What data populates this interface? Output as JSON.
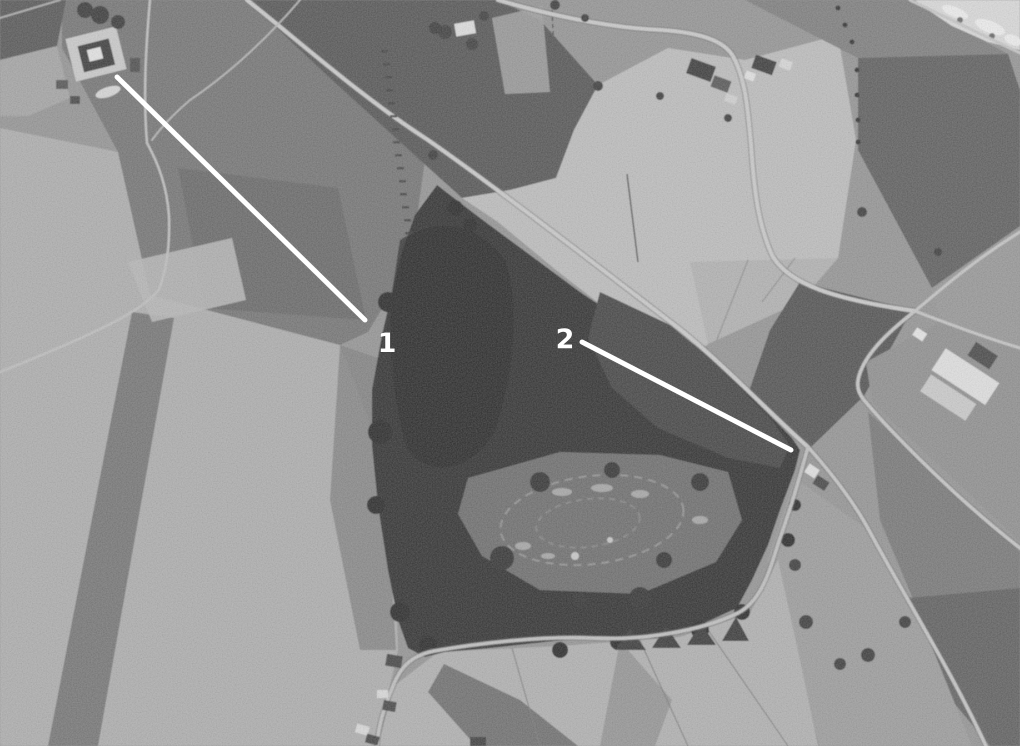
{
  "annotations": {
    "color": "#ffffff",
    "halo_color": "#333333",
    "items": [
      {
        "label": "1",
        "line": {
          "x1": 117,
          "y1": 77,
          "x2": 365,
          "y2": 320
        },
        "label_x": 387,
        "label_y": 352
      },
      {
        "label": "2",
        "line": {
          "x1": 582,
          "y1": 342,
          "x2": 791,
          "y2": 450
        },
        "label_x": 565,
        "label_y": 348
      }
    ]
  },
  "palette": {
    "annotation": "#ffffff",
    "forest": "#323232",
    "scrub": "#454545",
    "fort_interior": "#6e6e6e",
    "field_light": "#bcbcbc",
    "field_medium": "#8f8f8f",
    "field_dark": "#565656",
    "road": "#c9c9c9",
    "building_light": "#dcdcdc",
    "building_dark": "#3e3e3e"
  }
}
